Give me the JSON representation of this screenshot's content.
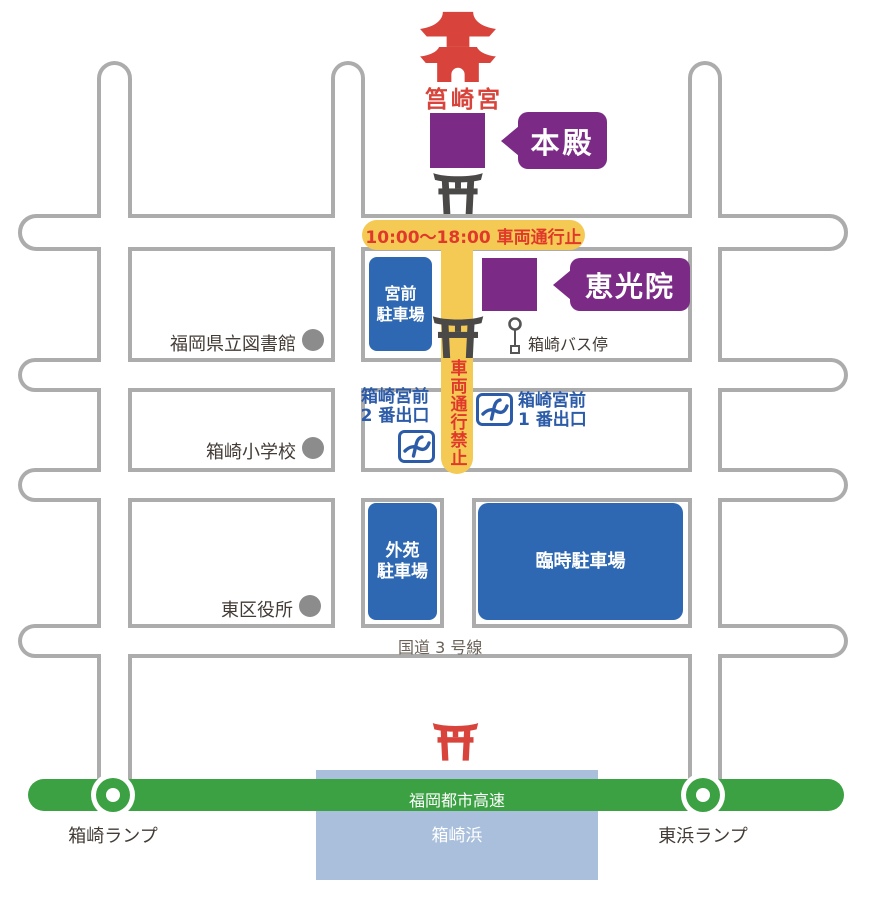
{
  "colors": {
    "road_gray": "#ACACAC",
    "closure_yellow": "#F4CA55",
    "closure_red": "#E0392B",
    "shrine_red": "#D8443B",
    "purple": "#7B2B86",
    "parking_blue": "#2E68B2",
    "subway_blue": "#2C5BA8",
    "expressway_green": "#3BA143",
    "sea_blue": "#A9BFDC",
    "torii_dark_gray": "#4B4948",
    "poi_dot_gray": "#8C8C8C"
  },
  "landmarks": {
    "shrine_name": "筥崎宮",
    "honden": "本殿",
    "ekoin": "恵光院",
    "library": "福岡県立図書館",
    "school": "箱崎小学校",
    "ward_office": "東区役所",
    "bus_stop": "箱崎バス停"
  },
  "traffic": {
    "closure_banner": "10:00〜18:00 車両通行止",
    "closure_vertical": "車両通行禁止"
  },
  "parking": {
    "miyamae": {
      "line1": "宮前",
      "line2": "駐車場"
    },
    "gaien": {
      "line1": "外苑",
      "line2": "駐車場"
    },
    "rinji": "臨時駐車場"
  },
  "subway": {
    "exit2": {
      "line1": "箱崎宮前",
      "line2": "2 番出口"
    },
    "exit1": {
      "line1": "箱崎宮前",
      "line2": "1 番出口"
    }
  },
  "roads": {
    "route3": "国道 3 号線",
    "expressway": "福岡都市高速",
    "hakozaki_ramp": "箱崎ランプ",
    "higashihama_ramp": "東浜ランプ"
  },
  "sea": {
    "label": "箱崎浜"
  }
}
